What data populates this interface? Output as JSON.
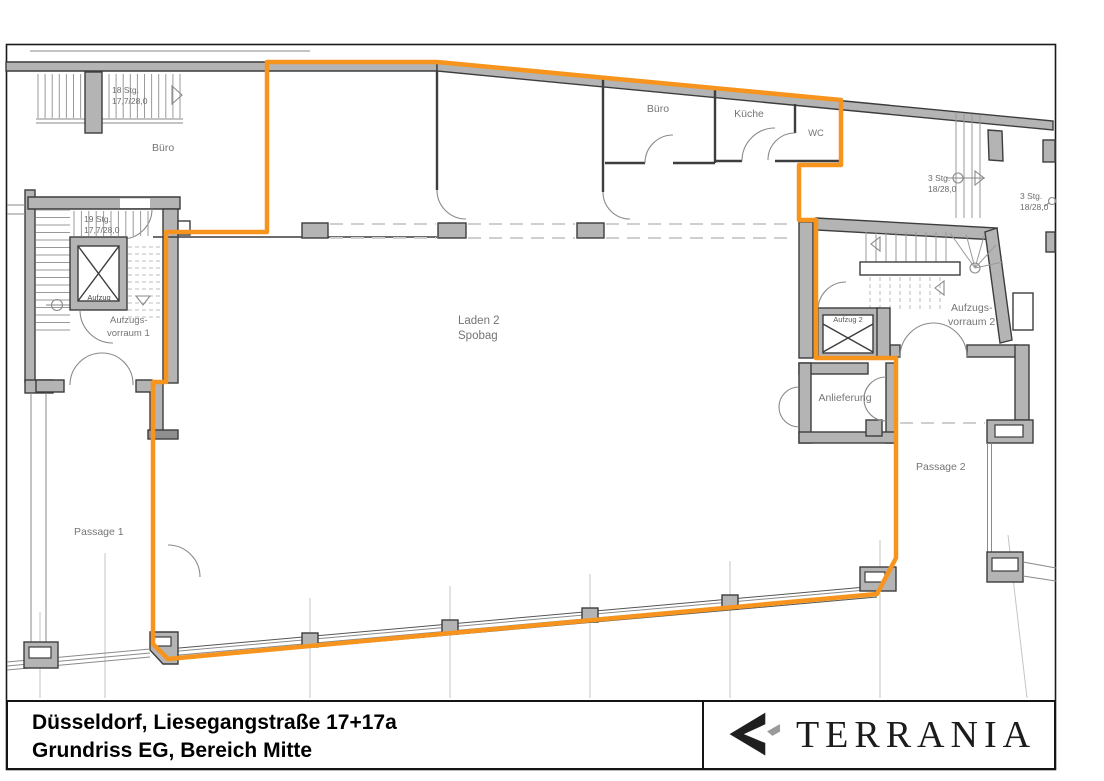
{
  "colors": {
    "highlight": "#F7941D",
    "wall_fill": "#b4b4b4",
    "wall_outline": "#3d3d3d",
    "label_gray": "#757575"
  },
  "rooms": {
    "buero_left": "Büro",
    "buero_top": "Büro",
    "kueche": "Küche",
    "wc": "WC",
    "laden_line1": "Laden 2",
    "laden_line2": "Spobag",
    "aufzug1": "Aufzug",
    "aufzug2": "Aufzug 2",
    "vorraum1_line1": "Aufzugs-",
    "vorraum1_line2": "vorraum 1",
    "vorraum2_line1": "Aufzugs-",
    "vorraum2_line2": "vorraum 2",
    "anlieferung": "Anlieferung",
    "passage1": "Passage 1",
    "passage2": "Passage 2"
  },
  "stairs": {
    "s18_line1": "18 Stg.",
    "s18_line2": "17,7/28,0",
    "s19_line1": "19 Stg.",
    "s19_line2": "17,7/28,0",
    "s3a_line1": "3 Stg.",
    "s3a_line2": "18/28,0",
    "s3b_line1": "3 Stg.",
    "s3b_line2": "18/28,0"
  },
  "title_block": {
    "line1": "Düsseldorf, Liesegangstraße 17+17a",
    "line2": "Grundriss EG, Bereich Mitte",
    "company": "TERRANIA"
  }
}
